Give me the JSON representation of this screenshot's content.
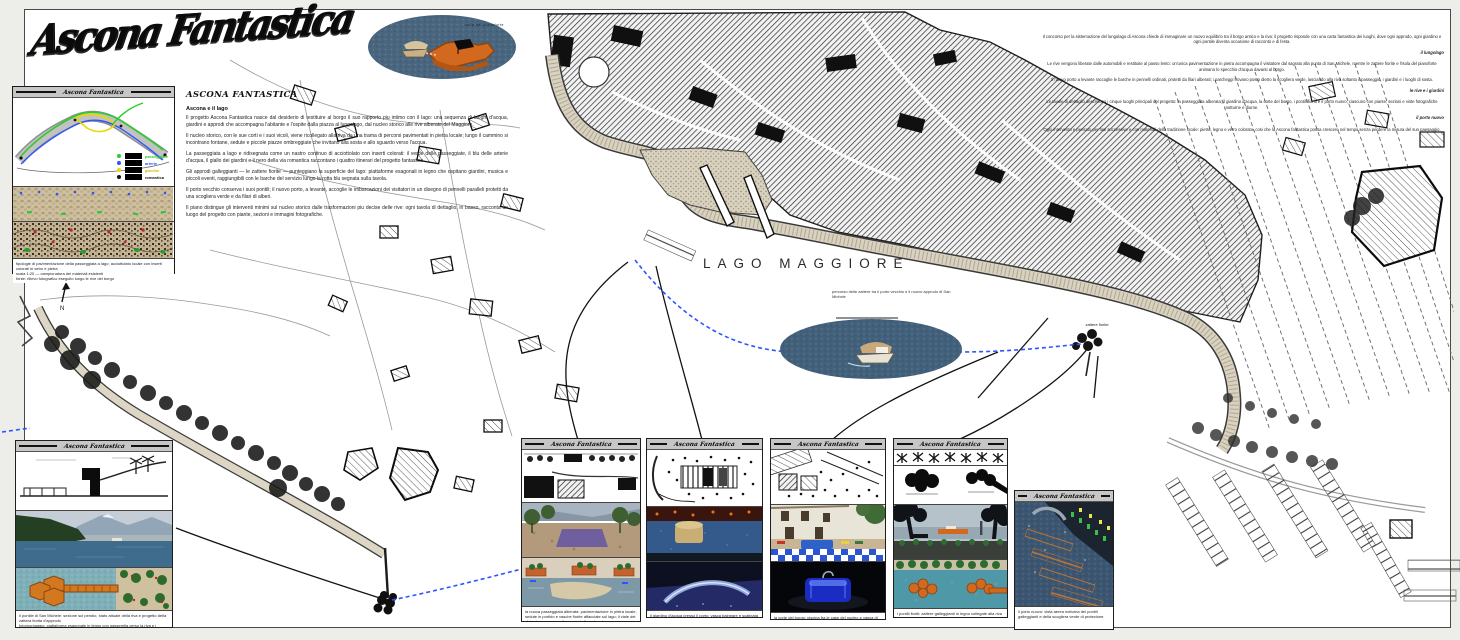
{
  "board": {
    "title": "Ascona Fantastica",
    "lake_label": "LAGO MAGGIORE",
    "lake_note": "percorso delle zattere tra il porto vecchio e il nuovo approdo di San Michele",
    "north_label": "N",
    "raft_cluster_label": "zattere fiorite"
  },
  "island_render": {
    "label": "isola del pianoforte"
  },
  "left_inset": {
    "logo": "Ascona Fantastica",
    "legend": [
      {
        "label": "passeggiate",
        "color": "#2ecc2e"
      },
      {
        "label": "arterie",
        "color": "#2b55ff"
      },
      {
        "label": "giardini",
        "color": "#e8d800"
      },
      {
        "label": "romantica",
        "color": "#111111"
      }
    ],
    "caption_lines": [
      "tipologie di pavimentazione della passeggiata a lago: acciottolato locale con inserti colorati in vetro e pietra",
      "scala 1:20 — campionatura dei materiali esistenti",
      "fonte: rilievo fotografico eseguito lungo le rive del borgo"
    ]
  },
  "description": {
    "heading": "ASCONA FANTASTICA",
    "lead": "Ascona e il lago",
    "paragraphs": [
      "Il progetto Ascona Fantastica nasce dal desiderio di restituire al borgo il suo rapporto piu intimo con il lago: una sequenza di luoghi d'acqua, giardini e approdi che accompagna l'abitante e l'ospite dalla piazza al lungolago, dal nucleo storico alle rive alberate del Maggiore.",
      "Il nucleo storico, con le sue corti e i suoi vicoli, viene ricollegato alla riva da una trama di percorsi pavimentati in pietra locale; lungo il cammino si incontrano fontane, sedute e piccole piazze ombreggiate che invitano alla sosta e allo sguardo verso l'acqua.",
      "La passeggiata a lago e ridisegnata come un nastro continuo di acciottolato con inserti colorati: il verde delle passeggiate, il blu delle arterie d'acqua, il giallo dei giardini e il nero della via romantica raccontano i quattro itinerari del progetto fantastico.",
      "Gli approdi galleggianti — le zattere fiorite — punteggiano la superficie del lago: piattaforme esagonali in legno che ospitano giardini, musica e piccoli eventi, raggiungibili con le barche del servizio lungo la rotta blu segnata sulla tavola.",
      "Il porto vecchio conserva i suoi pontili; il nuovo porto, a levante, accoglie le imbarcazioni dei visitatori in un disegno di pennelli paralleli protetti da una scogliera verde e da filari di alberi.",
      "Il piano distingue gli interventi minimi sul nucleo storico dalle trasformazioni piu decise delle rive: ogni tavola di dettaglio, in basso, racconta un luogo del progetto con piante, sezioni e immagini fotografiche."
    ]
  },
  "top_right": {
    "paragraphs": [
      "Il concorso per la sistemazione del lungolago di Ascona chiede di immaginare un nuovo equilibrio tra il borgo antico e la riva: il progetto risponde con una carta fantastica dei luoghi, dove ogni approdo, ogni giardino e ogni pontile diventa occasione di racconto e di festa.",
      "Le rive vengono liberate dalle automobili e restituite al passo lento: un'unica pavimentazione in pietra accompagna il visitatore dal sagrato alla punta di San Michele, mentre le zattere fiorite e l'isola del pianoforte animano lo specchio d'acqua davanti al borgo.",
      "Il nuovo porto a levante raccoglie le barche in pennelli ordinati, protetti da filari alberati; i parcheggi trovano posto dietro la scogliera verde, lasciando alla riva soltanto il passeggio, i giardini e i luoghi di sosta.",
      "Le tavole di dettaglio descrivono i cinque luoghi principali del progetto: la passeggiata alberata, il giardino d'acqua, la corte del borgo, i pontili fioriti e il porto nuovo, ciascuno con piante, sezioni e viste fotografiche notturne e diurne.",
      "Ogni intervento e pensato per fasi successive e con materiali della tradizione locale: pietra, legno e vetro colorato, cosi che la Ascona fantastica possa crescere nel tempo senza perdere la misura del suo paesaggio."
    ],
    "signatures": [
      "il lungolago",
      "le rive e i giardini",
      "il porto nuovo"
    ]
  },
  "panels": [
    {
      "logo": "Ascona Fantastica",
      "caption": "la nuova passeggiata alberata: pavimentazione in pietra locale, sedute in porfido e vasche fiorite affacciate sul lago; il viale dei platani accompagna il passeggio fino al porto."
    },
    {
      "logo": "Ascona Fantastica",
      "caption": "il giardino d'acqua presso il porto: vasca balneare e scalinata luminosa che scende verso il lago nelle ore della sera."
    },
    {
      "logo": "Ascona Fantastica",
      "caption": "la corte del borgo: piscina fra le case del nucleo e vasca di vetro blu illuminata nella notte."
    },
    {
      "logo": "Ascona Fantastica",
      "caption": "i pontili fioriti: zattere galleggianti in legno collegate alla riva alberata; vista dal viale e dall'acqua."
    },
    {
      "logo": "Ascona Fantastica",
      "caption": "il porto nuovo: vista aerea notturna dei pontili galleggianti e della scogliera verde di protezione."
    }
  ],
  "bottom_left_panel": {
    "logo": "Ascona Fantastica",
    "caption_lines": [
      "il pontile di San Michele: sezione sul pendio, stato attuale della riva e progetto della zattera fiorita d'approdo",
      "fotomontaggio: piattaforma esagonale in legno con passerella verso la riva e i giardini"
    ]
  }
}
